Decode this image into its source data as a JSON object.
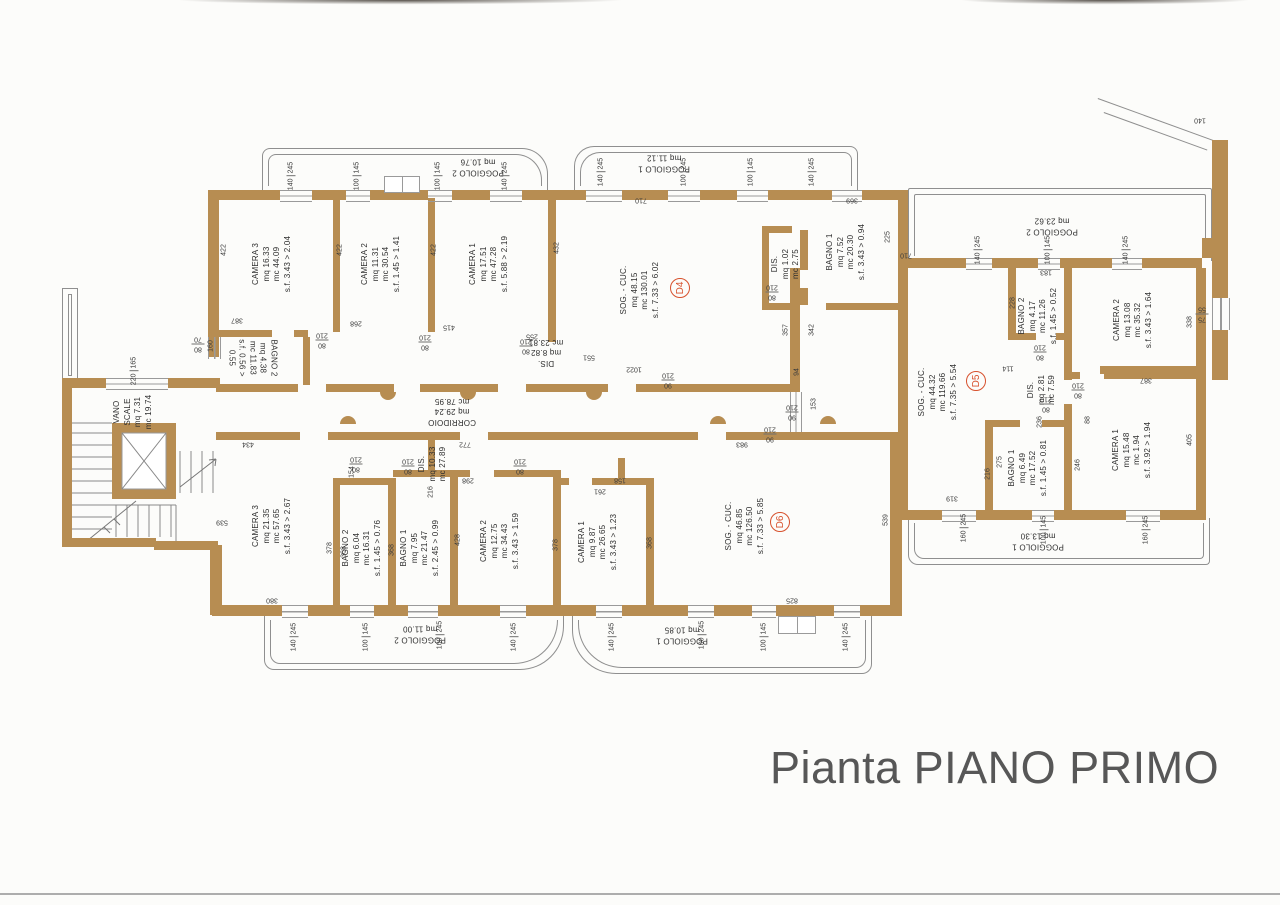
{
  "title": "Pianta PIANO PRIMO",
  "colors": {
    "wall": "#b78d52",
    "line": "#8f8f8f",
    "text": "#2e2e2e",
    "badge": "#d7512d",
    "title": "#575757"
  },
  "apartments": [
    {
      "code": "D4",
      "x": 680,
      "y": 288
    },
    {
      "code": "D5",
      "x": 976,
      "y": 381
    },
    {
      "code": "D6",
      "x": 780,
      "y": 522
    }
  ],
  "rooms": [
    {
      "id": "d4-camera-3",
      "lines": [
        "CAMERA 3",
        "mq 16.33",
        "mc 44.09",
        "s.f. 3.43 > 2.04"
      ],
      "x": 272,
      "y": 264,
      "rot": -90
    },
    {
      "id": "d4-camera-2",
      "lines": [
        "CAMERA 2",
        "mq 11.31",
        "mc 30.54",
        "s.f. 1.45 > 1.41"
      ],
      "x": 381,
      "y": 264,
      "rot": -90
    },
    {
      "id": "d4-camera-1",
      "lines": [
        "CAMERA 1",
        "mq 17.51",
        "mc 47.28",
        "s.f. 5.88 > 2.19"
      ],
      "x": 489,
      "y": 264,
      "rot": -90
    },
    {
      "id": "d4-bagno-2",
      "lines": [
        "BAGNO 2",
        "mq 4.38",
        "mc 11.83",
        "s.f. 0.56 >",
        "0.55"
      ],
      "x": 252,
      "y": 358,
      "rot": 90
    },
    {
      "id": "d4-dis",
      "lines": [
        "DIS.",
        "mq 8.82",
        "mc 23.81"
      ],
      "x": 546,
      "y": 352,
      "rot": 180
    },
    {
      "id": "d4-soggiorno-cucina",
      "lines": [
        "SOG. - CUC.",
        "mq 48.15",
        "mc 130.01",
        "s.f. 7.33 > 6.02"
      ],
      "x": 640,
      "y": 290,
      "rot": -90
    },
    {
      "id": "d4-dis-2",
      "lines": [
        "DIS.",
        "mq 1.02",
        "mc 2.75"
      ],
      "x": 786,
      "y": 264,
      "rot": -90
    },
    {
      "id": "d4-bagno-1",
      "lines": [
        "BAGNO 1",
        "mq 7.52",
        "mc 20.30",
        "s.f. 3.43 > 0.94"
      ],
      "x": 846,
      "y": 252,
      "rot": -90
    },
    {
      "id": "d4-poggiolo-2",
      "lines": [
        "POGGIOLO 2",
        "mq 10.76"
      ],
      "x": 478,
      "y": 167,
      "rot": 180
    },
    {
      "id": "d4-poggiolo-1",
      "lines": [
        "POGGIOLO 1",
        "mq 11.12"
      ],
      "x": 664,
      "y": 163,
      "rot": 180
    },
    {
      "id": "d5-soggiorno-cucina",
      "lines": [
        "SOG. - CUC.",
        "mq 44.32",
        "mc 119.66",
        "s.f. 7.35 > 5.54"
      ],
      "x": 938,
      "y": 392,
      "rot": -90
    },
    {
      "id": "d5-bagno-2",
      "lines": [
        "BAGNO 2",
        "mq 4.17",
        "mc 11.26",
        "s.f. 1.45 > 0.52"
      ],
      "x": 1038,
      "y": 316,
      "rot": -90
    },
    {
      "id": "d5-camera-2",
      "lines": [
        "CAMERA 2",
        "mq 13.08",
        "mc 35.32",
        "s.f. 3.43 > 1.64"
      ],
      "x": 1133,
      "y": 320,
      "rot": -90
    },
    {
      "id": "d5-dis",
      "lines": [
        "DIS.",
        "mq 2.81",
        "mc 7.59"
      ],
      "x": 1042,
      "y": 390,
      "rot": -90
    },
    {
      "id": "d5-bagno-1",
      "lines": [
        "BAGNO 1",
        "mq 6.49",
        "mc 17.52",
        "s.f. 1.45 > 0.81"
      ],
      "x": 1028,
      "y": 468,
      "rot": -90
    },
    {
      "id": "d5-camera-1",
      "lines": [
        "CAMERA 1",
        "mq 15.48",
        "mc 1.94",
        "s.f. 3.92 > 1.94"
      ],
      "x": 1132,
      "y": 450,
      "rot": -90
    },
    {
      "id": "d5-poggiolo-2",
      "lines": [
        "POGGIOLO 2",
        "mq 23.62"
      ],
      "x": 1052,
      "y": 226,
      "rot": 180
    },
    {
      "id": "d5-poggiolo-1",
      "lines": [
        "POGGIOLO 1",
        "mq 13.30"
      ],
      "x": 1038,
      "y": 541,
      "rot": 180
    },
    {
      "id": "d6-camera-3",
      "lines": [
        "CAMERA 3",
        "mq 21.35",
        "mc 57.65",
        "s.f. 3.43 > 2.67"
      ],
      "x": 272,
      "y": 526,
      "rot": -90
    },
    {
      "id": "d6-bagno-2",
      "lines": [
        "BAGNO 2",
        "mq 6.04",
        "mc 16.31",
        "s.f. 1.45 > 0.76"
      ],
      "x": 362,
      "y": 548,
      "rot": -90
    },
    {
      "id": "d6-bagno-1",
      "lines": [
        "BAGNO 1",
        "mq 7.95",
        "mc 21.47",
        "s.f. 2.45 > 0.99"
      ],
      "x": 420,
      "y": 548,
      "rot": -90
    },
    {
      "id": "d6-camera-2",
      "lines": [
        "CAMERA 2",
        "mq 12.75",
        "mc 34.43",
        "s.f. 3.43 > 1.59"
      ],
      "x": 500,
      "y": 541,
      "rot": -90
    },
    {
      "id": "d6-dis",
      "lines": [
        "DIS.",
        "mq 10.33",
        "mc 27.89"
      ],
      "x": 433,
      "y": 464,
      "rot": -90
    },
    {
      "id": "d6-camera-1",
      "lines": [
        "CAMERA 1",
        "mq 9.87",
        "mc 26.65",
        "s.f. 3.43 > 1.23"
      ],
      "x": 598,
      "y": 542,
      "rot": -90
    },
    {
      "id": "d6-soggiorno-cucina",
      "lines": [
        "SOG. - CUC.",
        "mq 46.85",
        "mc 126.50",
        "s.f. 7.33 > 5.85"
      ],
      "x": 745,
      "y": 526,
      "rot": -90
    },
    {
      "id": "d6-poggiolo-2",
      "lines": [
        "POGGIOLO 2",
        "mq 11.00"
      ],
      "x": 420,
      "y": 634,
      "rot": 180
    },
    {
      "id": "d6-poggiolo-1",
      "lines": [
        "POGGIOLO 1",
        "mq 10.85"
      ],
      "x": 682,
      "y": 635,
      "rot": 180
    },
    {
      "id": "vano-scale",
      "lines": [
        "VANO",
        "SCALE",
        "mq 7.31",
        "mc 19.74"
      ],
      "x": 133,
      "y": 412,
      "rot": -90
    },
    {
      "id": "corridoio",
      "lines": [
        "CORRIDOIO",
        "mq 29.24",
        "mc 78.95"
      ],
      "x": 452,
      "y": 411,
      "rot": 180
    }
  ],
  "dims": [
    {
      "t": "140|245",
      "x": 291,
      "y": 176,
      "r": -90
    },
    {
      "t": "100|145",
      "x": 357,
      "y": 176,
      "r": -90
    },
    {
      "t": "100|145",
      "x": 438,
      "y": 176,
      "r": -90
    },
    {
      "t": "140|245",
      "x": 505,
      "y": 176,
      "r": -90
    },
    {
      "t": "140|245",
      "x": 601,
      "y": 172,
      "r": -90
    },
    {
      "t": "100|245",
      "x": 684,
      "y": 172,
      "r": -90
    },
    {
      "t": "100|145",
      "x": 751,
      "y": 172,
      "r": -90
    },
    {
      "t": "140|245",
      "x": 812,
      "y": 172,
      "r": -90
    },
    {
      "t": "710",
      "x": 641,
      "y": 200,
      "r": 180
    },
    {
      "t": "225",
      "x": 888,
      "y": 237,
      "r": -90
    },
    {
      "t": "710",
      "x": 906,
      "y": 255,
      "r": 180
    },
    {
      "t": "369",
      "x": 852,
      "y": 200,
      "r": 180
    },
    {
      "t": "422",
      "x": 224,
      "y": 250,
      "r": -90
    },
    {
      "t": "422",
      "x": 340,
      "y": 250,
      "r": -90
    },
    {
      "t": "422",
      "x": 434,
      "y": 250,
      "r": -90
    },
    {
      "t": "432",
      "x": 557,
      "y": 248,
      "r": -90
    },
    {
      "t": "387",
      "x": 237,
      "y": 320,
      "r": 180
    },
    {
      "t": "268",
      "x": 356,
      "y": 323,
      "r": 180
    },
    {
      "t": "415",
      "x": 449,
      "y": 327,
      "r": 180
    },
    {
      "t": "255",
      "x": 532,
      "y": 336,
      "r": 180
    },
    {
      "t": "80|210",
      "x": 322,
      "y": 340,
      "r": 180
    },
    {
      "t": "80|210",
      "x": 425,
      "y": 342,
      "r": 180
    },
    {
      "t": "80|210",
      "x": 526,
      "y": 346,
      "r": 180
    },
    {
      "t": "160",
      "x": 211,
      "y": 346,
      "r": -90
    },
    {
      "t": "80|70",
      "x": 198,
      "y": 344,
      "r": 180
    },
    {
      "t": "220|165",
      "x": 134,
      "y": 371,
      "r": -90
    },
    {
      "t": "551",
      "x": 589,
      "y": 357,
      "r": 180
    },
    {
      "t": "1022",
      "x": 634,
      "y": 369,
      "r": 180
    },
    {
      "t": "90|210",
      "x": 668,
      "y": 380,
      "r": 180
    },
    {
      "t": "94",
      "x": 797,
      "y": 372,
      "r": -90
    },
    {
      "t": "357",
      "x": 786,
      "y": 330,
      "r": -90
    },
    {
      "t": "342",
      "x": 812,
      "y": 330,
      "r": -90
    },
    {
      "t": "153",
      "x": 814,
      "y": 404,
      "r": -90
    },
    {
      "t": "90|210",
      "x": 792,
      "y": 412,
      "r": 180
    },
    {
      "t": "80|210",
      "x": 772,
      "y": 292,
      "r": 180
    },
    {
      "t": "434",
      "x": 248,
      "y": 444,
      "r": 180
    },
    {
      "t": "772",
      "x": 465,
      "y": 444,
      "r": 180
    },
    {
      "t": "983",
      "x": 742,
      "y": 444,
      "r": 180
    },
    {
      "t": "90|210",
      "x": 770,
      "y": 434,
      "r": 180
    },
    {
      "t": "539",
      "x": 222,
      "y": 522,
      "r": 180
    },
    {
      "t": "539",
      "x": 886,
      "y": 520,
      "r": -90
    },
    {
      "t": "378",
      "x": 330,
      "y": 548,
      "r": -90
    },
    {
      "t": "368",
      "x": 344,
      "y": 552,
      "r": -90
    },
    {
      "t": "154",
      "x": 352,
      "y": 472,
      "r": -90
    },
    {
      "t": "80|210",
      "x": 356,
      "y": 464,
      "r": 180
    },
    {
      "t": "80|210",
      "x": 408,
      "y": 466,
      "r": 180
    },
    {
      "t": "216",
      "x": 431,
      "y": 492,
      "r": -90
    },
    {
      "t": "298",
      "x": 468,
      "y": 480,
      "r": 180
    },
    {
      "t": "80|210",
      "x": 520,
      "y": 466,
      "r": 180
    },
    {
      "t": "368",
      "x": 392,
      "y": 550,
      "r": -90
    },
    {
      "t": "428",
      "x": 458,
      "y": 540,
      "r": -90
    },
    {
      "t": "378",
      "x": 556,
      "y": 545,
      "r": -90
    },
    {
      "t": "368",
      "x": 650,
      "y": 543,
      "r": -90
    },
    {
      "t": "261",
      "x": 600,
      "y": 491,
      "r": 180
    },
    {
      "t": "158",
      "x": 620,
      "y": 480,
      "r": 180
    },
    {
      "t": "825",
      "x": 792,
      "y": 600,
      "r": 180
    },
    {
      "t": "380",
      "x": 272,
      "y": 600,
      "r": 180
    },
    {
      "t": "140|245",
      "x": 294,
      "y": 637,
      "r": -90
    },
    {
      "t": "100|145",
      "x": 366,
      "y": 637,
      "r": -90
    },
    {
      "t": "100|245",
      "x": 440,
      "y": 635,
      "r": -90
    },
    {
      "t": "140|245",
      "x": 514,
      "y": 637,
      "r": -90
    },
    {
      "t": "140|245",
      "x": 612,
      "y": 637,
      "r": -90
    },
    {
      "t": "100|245",
      "x": 702,
      "y": 635,
      "r": -90
    },
    {
      "t": "100|145",
      "x": 764,
      "y": 637,
      "r": -90
    },
    {
      "t": "140|245",
      "x": 846,
      "y": 637,
      "r": -90
    },
    {
      "t": "140|245",
      "x": 978,
      "y": 250,
      "r": -90
    },
    {
      "t": "100|145",
      "x": 1048,
      "y": 250,
      "r": -90
    },
    {
      "t": "140|245",
      "x": 1126,
      "y": 250,
      "r": -90
    },
    {
      "t": "183",
      "x": 1046,
      "y": 272,
      "r": 180
    },
    {
      "t": "228",
      "x": 1013,
      "y": 303,
      "r": -90
    },
    {
      "t": "338",
      "x": 1190,
      "y": 322,
      "r": -90
    },
    {
      "t": "80|210",
      "x": 1040,
      "y": 352,
      "r": 180
    },
    {
      "t": "80|210",
      "x": 1046,
      "y": 404,
      "r": 180
    },
    {
      "t": "114",
      "x": 1008,
      "y": 368,
      "r": 180
    },
    {
      "t": "236",
      "x": 1040,
      "y": 422,
      "r": -90
    },
    {
      "t": "80|210",
      "x": 1078,
      "y": 390,
      "r": 180
    },
    {
      "t": "387",
      "x": 1146,
      "y": 380,
      "r": 180
    },
    {
      "t": "88",
      "x": 1088,
      "y": 420,
      "r": -90
    },
    {
      "t": "275",
      "x": 1000,
      "y": 462,
      "r": -90
    },
    {
      "t": "216",
      "x": 988,
      "y": 474,
      "r": -90
    },
    {
      "t": "246",
      "x": 1078,
      "y": 465,
      "r": -90
    },
    {
      "t": "405",
      "x": 1190,
      "y": 440,
      "r": -90
    },
    {
      "t": "319",
      "x": 952,
      "y": 498,
      "r": 180
    },
    {
      "t": "160|245",
      "x": 964,
      "y": 528,
      "r": -90
    },
    {
      "t": "100|145",
      "x": 1044,
      "y": 530,
      "r": -90
    },
    {
      "t": "160|245",
      "x": 1146,
      "y": 530,
      "r": -90
    },
    {
      "t": "75|55",
      "x": 1202,
      "y": 314,
      "r": 180
    },
    {
      "t": "140",
      "x": 1200,
      "y": 120,
      "r": 180
    }
  ]
}
